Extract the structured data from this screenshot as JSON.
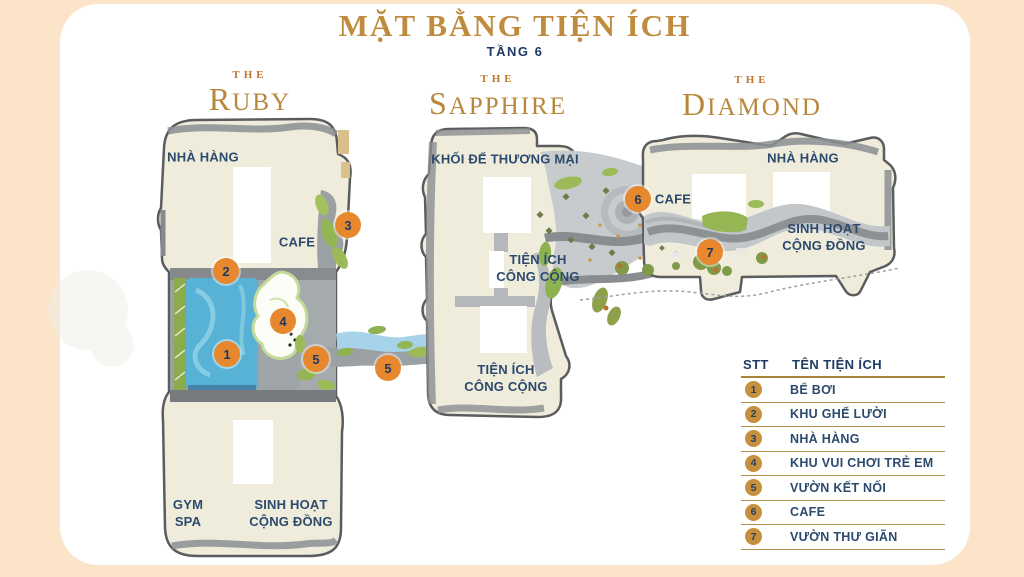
{
  "header": {
    "title": "MẶT BẰNG TIỆN ÍCH",
    "subtitle": "TẦNG 6"
  },
  "towers": [
    {
      "prefix": "THE",
      "name": "RUBY"
    },
    {
      "prefix": "THE",
      "name": "SAPPHIRE"
    },
    {
      "prefix": "THE",
      "name": "DIAMOND"
    }
  ],
  "plan_labels": [
    {
      "text": "NHÀ HÀNG"
    },
    {
      "text": "CAFE"
    },
    {
      "text": "GYM\nSPA"
    },
    {
      "text": "SINH HOẠT\nCỘNG ĐỒNG"
    },
    {
      "text": "KHỐI ĐẾ THƯƠNG MẠI"
    },
    {
      "text": "TIỆN ÍCH\nCÔNG CỘNG"
    },
    {
      "text": "TIỆN ÍCH\nCÔNG CỘNG"
    },
    {
      "text": "NHÀ HÀNG"
    },
    {
      "text": "CAFE"
    },
    {
      "text": "SINH HOẠT\nCỘNG ĐỒNG"
    }
  ],
  "map_markers": [
    {
      "n": "1"
    },
    {
      "n": "2"
    },
    {
      "n": "3"
    },
    {
      "n": "4"
    },
    {
      "n": "5"
    },
    {
      "n": "5"
    },
    {
      "n": "6"
    },
    {
      "n": "7"
    }
  ],
  "legend": {
    "col_num": "STT",
    "col_name": "TÊN TIỆN ÍCH",
    "rows": [
      {
        "num": "1",
        "name": "BỂ BƠI"
      },
      {
        "num": "2",
        "name": "KHU GHẾ LƯỜI"
      },
      {
        "num": "3",
        "name": "NHÀ HÀNG"
      },
      {
        "num": "4",
        "name": "KHU VUI CHƠI TRẺ EM"
      },
      {
        "num": "5",
        "name": "VƯỜN KẾT NỐI"
      },
      {
        "num": "6",
        "name": "CAFE"
      },
      {
        "num": "7",
        "name": "VƯỜN THƯ GIÃN"
      }
    ]
  },
  "colors": {
    "background_peach": "#fce4c8",
    "panel_white": "#ffffff",
    "title_gold": "#bf8b3f",
    "navy_text": "#2b4a6e",
    "marker_orange": "#e8882e",
    "legend_gold_circle": "#c6903f",
    "legend_line_gold": "#a8853c",
    "building_cream": "#f0ecdc",
    "building_outline_gray": "#5a5c5e",
    "path_gray": "#9aa0a4",
    "pool_blue": "#57b2d5",
    "stream_blue": "#a6d3e9",
    "green_landscape": "#93b553"
  }
}
